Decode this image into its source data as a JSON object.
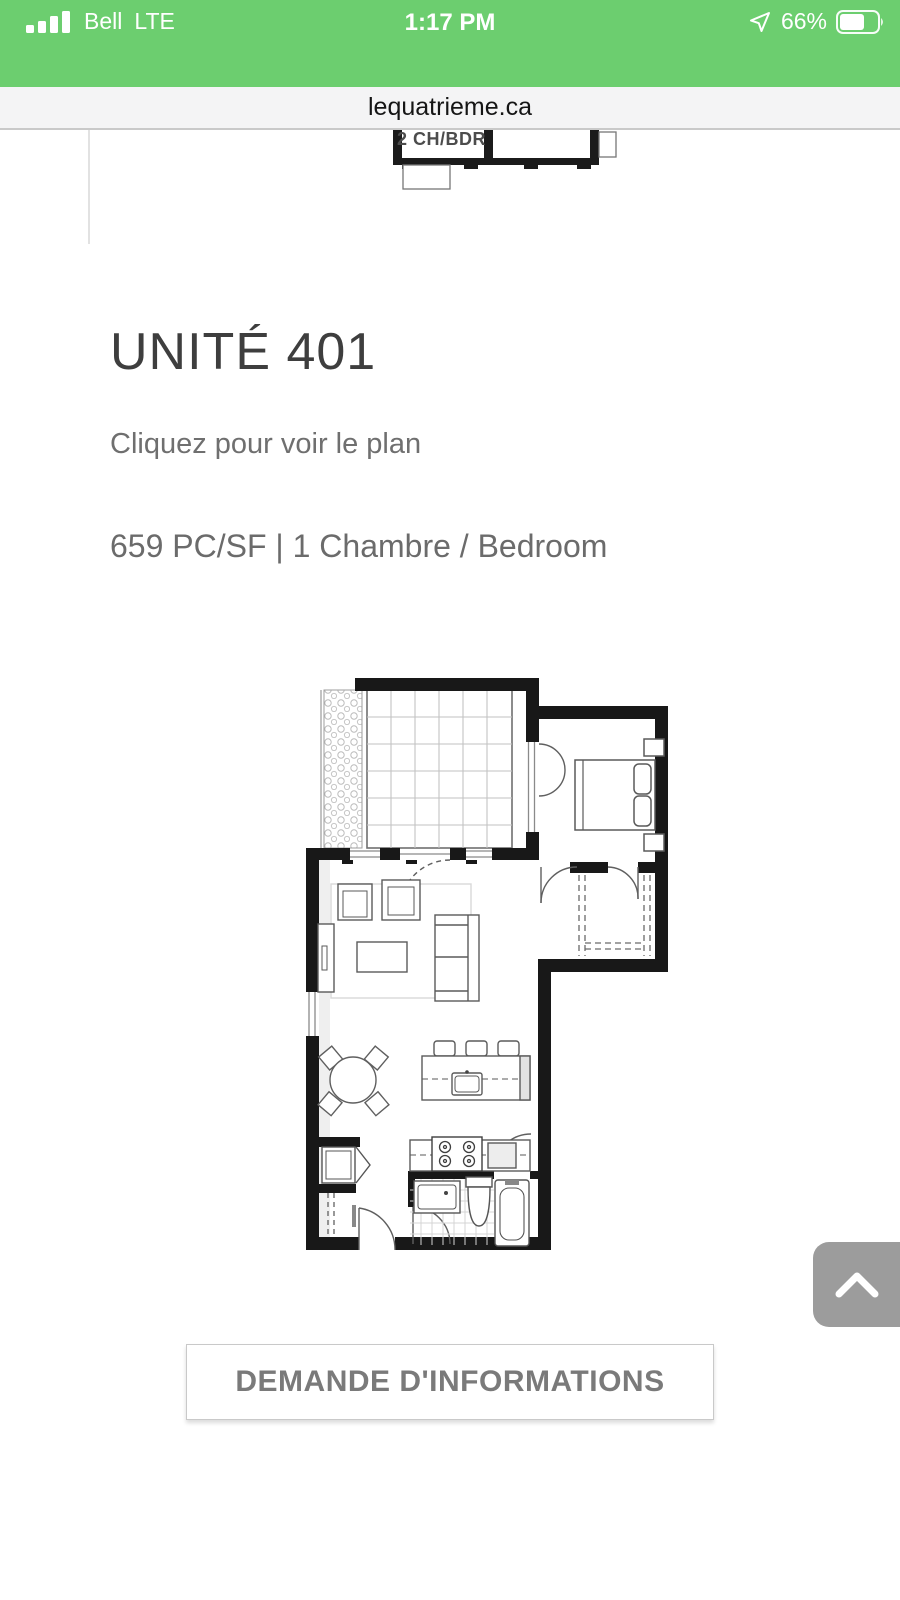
{
  "status_bar": {
    "carrier": "Bell",
    "network": "LTE",
    "time": "1:17 PM",
    "battery_percent": "66%"
  },
  "browser": {
    "url": "lequatrieme.ca"
  },
  "previous_unit_plan": {
    "room_label": "2 CH/BDR"
  },
  "unit": {
    "title": "UNITÉ 401",
    "hint": "Cliquez pour voir le plan",
    "specs": "659 PC/SF | 1 Chambre / Bedroom"
  },
  "cta": {
    "label": "DEMANDE D'INFORMATIONS"
  },
  "icons": {
    "signal": "signal-bars",
    "location": "location-arrow",
    "battery": "battery-two-thirds",
    "scroll_top": "chevron-up"
  },
  "colors": {
    "header_green": "#6cce6f",
    "url_bar_bg": "#f4f4f5",
    "title_text": "#3e3e3e",
    "body_text": "#6b6b6b",
    "button_text": "#7a7a7a",
    "button_border": "#c9c9c9",
    "scroll_button_bg": "#9c9c9c",
    "plan_wall": "#181818"
  }
}
